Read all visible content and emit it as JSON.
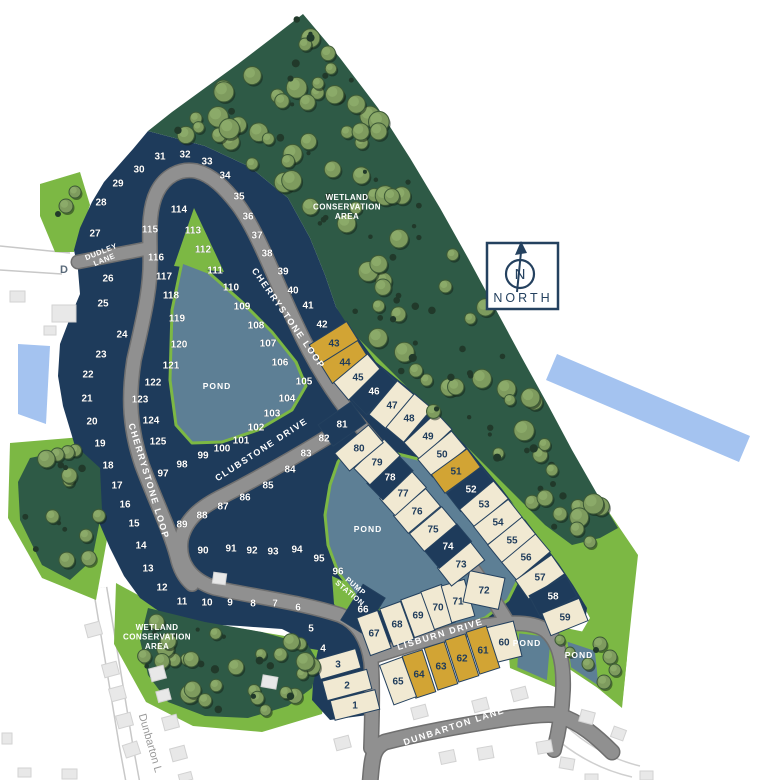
{
  "palette": {
    "navy": "#1e3b5b",
    "cream": "#f1e9d2",
    "gold": "#d2a434",
    "forest": "#2e5a46",
    "grass": "#7cb844",
    "pond": "#5d7f95",
    "road": "#909090",
    "road_edge": "#6f6f6f",
    "stream": "#a4c3f0",
    "house": "#e8e8e8"
  },
  "compass": {
    "letter": "N",
    "label": "NORTH"
  },
  "road_labels": [
    {
      "text": "CHERRYSTONE LOOP",
      "x": 286,
      "y": 320,
      "rot": 55,
      "cls": "roadlbl"
    },
    {
      "text": "CHERRYSTONE LOOP",
      "x": 146,
      "y": 482,
      "rot": 73,
      "cls": "roadlbl"
    },
    {
      "text": "CLUBSTONE DRIVE",
      "x": 263,
      "y": 452,
      "rot": -33,
      "cls": "roadlbl"
    },
    {
      "text": "LISBURN DRIVE",
      "x": 441,
      "y": 637,
      "rot": -17,
      "cls": "roadlbl"
    },
    {
      "text": "DUNBARTON LANE",
      "x": 455,
      "y": 729,
      "rot": -18,
      "cls": "roadlbl"
    }
  ],
  "dudley": {
    "lines": [
      "DUDLEY",
      "LANE"
    ],
    "x": 102,
    "y": 254,
    "rot": -22
  },
  "pump_station": {
    "lines": [
      "PUMP",
      "STATION"
    ],
    "x": 354,
    "y": 588,
    "rot": 40
  },
  "wetlands": [
    {
      "lines": [
        "WETLAND",
        "CONSERVATION",
        "AREA"
      ],
      "x": 347,
      "y": 200
    },
    {
      "lines": [
        "WETLAND",
        "CONSERVATION",
        "AREA"
      ],
      "x": 157,
      "y": 630
    }
  ],
  "ponds": [
    {
      "text": "POND",
      "x": 217,
      "y": 389
    },
    {
      "text": "POND",
      "x": 368,
      "y": 532
    },
    {
      "text": "POND",
      "x": 527,
      "y": 646
    },
    {
      "text": "POND",
      "x": 579,
      "y": 658
    }
  ],
  "offsite": {
    "dunbarton_fragment": "Dunbarton L",
    "dx": 147,
    "dy": 744,
    "drot": 74,
    "d_fragment": "D",
    "fx": 64,
    "fy": 273
  },
  "lots": [
    {
      "n": "1",
      "x": 355,
      "y": 705,
      "c": "cream",
      "rw": 46,
      "rh": 20,
      "rr": -14
    },
    {
      "n": "2",
      "x": 347,
      "y": 685,
      "c": "cream",
      "rw": 46,
      "rh": 20,
      "rr": -15
    },
    {
      "n": "3",
      "x": 338,
      "y": 664,
      "c": "cream",
      "rw": 42,
      "rh": 20,
      "rr": -16
    },
    {
      "n": "4",
      "x": 323,
      "y": 648,
      "c": "navy"
    },
    {
      "n": "5",
      "x": 311,
      "y": 628,
      "c": "navy"
    },
    {
      "n": "6",
      "x": 298,
      "y": 607,
      "c": "navy"
    },
    {
      "n": "7",
      "x": 275,
      "y": 603,
      "c": "navy"
    },
    {
      "n": "8",
      "x": 253,
      "y": 603,
      "c": "navy"
    },
    {
      "n": "9",
      "x": 230,
      "y": 602,
      "c": "navy"
    },
    {
      "n": "10",
      "x": 207,
      "y": 602,
      "c": "navy"
    },
    {
      "n": "11",
      "x": 182,
      "y": 601,
      "c": "navy"
    },
    {
      "n": "12",
      "x": 162,
      "y": 587,
      "c": "navy"
    },
    {
      "n": "13",
      "x": 148,
      "y": 568,
      "c": "navy"
    },
    {
      "n": "14",
      "x": 141,
      "y": 545,
      "c": "navy"
    },
    {
      "n": "15",
      "x": 134,
      "y": 523,
      "c": "navy"
    },
    {
      "n": "16",
      "x": 125,
      "y": 504,
      "c": "navy"
    },
    {
      "n": "17",
      "x": 117,
      "y": 485,
      "c": "navy"
    },
    {
      "n": "18",
      "x": 108,
      "y": 465,
      "c": "navy"
    },
    {
      "n": "19",
      "x": 100,
      "y": 443,
      "c": "navy"
    },
    {
      "n": "20",
      "x": 92,
      "y": 421,
      "c": "navy"
    },
    {
      "n": "21",
      "x": 87,
      "y": 398,
      "c": "navy"
    },
    {
      "n": "22",
      "x": 88,
      "y": 374,
      "c": "navy"
    },
    {
      "n": "23",
      "x": 101,
      "y": 354,
      "c": "navy"
    },
    {
      "n": "24",
      "x": 122,
      "y": 334,
      "c": "navy"
    },
    {
      "n": "25",
      "x": 103,
      "y": 303,
      "c": "navy"
    },
    {
      "n": "26",
      "x": 108,
      "y": 278,
      "c": "navy"
    },
    {
      "n": "27",
      "x": 95,
      "y": 233,
      "c": "navy"
    },
    {
      "n": "28",
      "x": 101,
      "y": 202,
      "c": "navy"
    },
    {
      "n": "29",
      "x": 118,
      "y": 183,
      "c": "navy"
    },
    {
      "n": "30",
      "x": 139,
      "y": 169,
      "c": "navy"
    },
    {
      "n": "31",
      "x": 160,
      "y": 156,
      "c": "navy"
    },
    {
      "n": "32",
      "x": 185,
      "y": 154,
      "c": "navy"
    },
    {
      "n": "33",
      "x": 207,
      "y": 161,
      "c": "navy"
    },
    {
      "n": "34",
      "x": 225,
      "y": 175,
      "c": "navy"
    },
    {
      "n": "35",
      "x": 239,
      "y": 196,
      "c": "navy"
    },
    {
      "n": "36",
      "x": 248,
      "y": 216,
      "c": "navy"
    },
    {
      "n": "37",
      "x": 257,
      "y": 235,
      "c": "navy"
    },
    {
      "n": "38",
      "x": 267,
      "y": 253,
      "c": "navy"
    },
    {
      "n": "39",
      "x": 283,
      "y": 271,
      "c": "navy"
    },
    {
      "n": "40",
      "x": 293,
      "y": 290,
      "c": "navy"
    },
    {
      "n": "41",
      "x": 308,
      "y": 305,
      "c": "navy"
    },
    {
      "n": "42",
      "x": 322,
      "y": 324,
      "c": "navy"
    },
    {
      "n": "43",
      "x": 334,
      "y": 343,
      "c": "gold",
      "rw": 23,
      "rh": 44,
      "rr": 58
    },
    {
      "n": "44",
      "x": 345,
      "y": 362,
      "c": "gold",
      "rw": 23,
      "rh": 44,
      "rr": 58
    },
    {
      "n": "45",
      "x": 358,
      "y": 377,
      "c": "cream",
      "rw": 23,
      "rh": 44,
      "rr": 50
    },
    {
      "n": "46",
      "x": 374,
      "y": 391,
      "c": "navy",
      "rw": 23,
      "rh": 44,
      "rr": 45
    },
    {
      "n": "47",
      "x": 392,
      "y": 405,
      "c": "cream",
      "rw": 23,
      "rh": 44,
      "rr": 40
    },
    {
      "n": "48",
      "x": 409,
      "y": 418,
      "c": "cream",
      "rw": 23,
      "rh": 44,
      "rr": 40
    },
    {
      "n": "49",
      "x": 428,
      "y": 436,
      "c": "cream",
      "rw": 23,
      "rh": 44,
      "rr": 47
    },
    {
      "n": "50",
      "x": 442,
      "y": 454,
      "c": "cream",
      "rw": 23,
      "rh": 44,
      "rr": 50
    },
    {
      "n": "51",
      "x": 456,
      "y": 471,
      "c": "gold",
      "rw": 23,
      "rh": 44,
      "rr": 54
    },
    {
      "n": "52",
      "x": 471,
      "y": 489,
      "c": "navy",
      "rw": 23,
      "rh": 44,
      "rr": 52
    },
    {
      "n": "53",
      "x": 484,
      "y": 504,
      "c": "cream",
      "rw": 23,
      "rh": 44,
      "rr": 50
    },
    {
      "n": "54",
      "x": 498,
      "y": 522,
      "c": "cream",
      "rw": 23,
      "rh": 44,
      "rr": 52
    },
    {
      "n": "55",
      "x": 512,
      "y": 540,
      "c": "cream",
      "rw": 23,
      "rh": 44,
      "rr": 51
    },
    {
      "n": "56",
      "x": 526,
      "y": 557,
      "c": "cream",
      "rw": 23,
      "rh": 44,
      "rr": 50
    },
    {
      "n": "57",
      "x": 540,
      "y": 577,
      "c": "cream",
      "rw": 23,
      "rh": 44,
      "rr": 55
    },
    {
      "n": "58",
      "x": 553,
      "y": 596,
      "c": "navy",
      "rw": 23,
      "rh": 42,
      "rr": 62
    },
    {
      "n": "59",
      "x": 565,
      "y": 617,
      "c": "cream",
      "rw": 24,
      "rh": 40,
      "rr": 68
    },
    {
      "n": "60",
      "x": 504,
      "y": 642,
      "c": "cream",
      "rw": 28,
      "rh": 36,
      "rr": -14
    },
    {
      "n": "61",
      "x": 483,
      "y": 650,
      "c": "gold",
      "rw": 21,
      "rh": 44,
      "rr": -18
    },
    {
      "n": "62",
      "x": 462,
      "y": 658,
      "c": "gold",
      "rw": 21,
      "rh": 44,
      "rr": -18
    },
    {
      "n": "63",
      "x": 441,
      "y": 666,
      "c": "gold",
      "rw": 21,
      "rh": 44,
      "rr": -18
    },
    {
      "n": "64",
      "x": 419,
      "y": 674,
      "c": "gold",
      "rw": 21,
      "rh": 44,
      "rr": -18
    },
    {
      "n": "65",
      "x": 398,
      "y": 681,
      "c": "cream",
      "rw": 24,
      "rh": 42,
      "rr": -20
    },
    {
      "n": "66",
      "x": 363,
      "y": 609,
      "c": "navy",
      "rw": 26,
      "rh": 42,
      "rr": 32
    },
    {
      "n": "67",
      "x": 374,
      "y": 633,
      "c": "cream",
      "rw": 22,
      "rh": 40,
      "rr": -20
    },
    {
      "n": "68",
      "x": 397,
      "y": 624,
      "c": "cream",
      "rw": 22,
      "rh": 40,
      "rr": -20
    },
    {
      "n": "69",
      "x": 418,
      "y": 615,
      "c": "cream",
      "rw": 22,
      "rh": 40,
      "rr": -20
    },
    {
      "n": "70",
      "x": 438,
      "y": 607,
      "c": "cream",
      "rw": 22,
      "rh": 40,
      "rr": -20
    },
    {
      "n": "71",
      "x": 458,
      "y": 601,
      "c": "cream",
      "rw": 24,
      "rh": 38,
      "rr": -16
    },
    {
      "n": "72",
      "x": 484,
      "y": 590,
      "c": "cream",
      "rw": 36,
      "rh": 32,
      "rr": 12
    },
    {
      "n": "73",
      "x": 461,
      "y": 564,
      "c": "cream",
      "rw": 23,
      "rh": 42,
      "rr": 52
    },
    {
      "n": "74",
      "x": 448,
      "y": 546,
      "c": "navy",
      "rw": 23,
      "rh": 42,
      "rr": 50
    },
    {
      "n": "75",
      "x": 433,
      "y": 529,
      "c": "cream",
      "rw": 23,
      "rh": 42,
      "rr": 50
    },
    {
      "n": "76",
      "x": 417,
      "y": 511,
      "c": "cream",
      "rw": 23,
      "rh": 42,
      "rr": 50
    },
    {
      "n": "77",
      "x": 403,
      "y": 493,
      "c": "cream",
      "rw": 23,
      "rh": 42,
      "rr": 48
    },
    {
      "n": "78",
      "x": 390,
      "y": 477,
      "c": "navy",
      "rw": 23,
      "rh": 42,
      "rr": 46
    },
    {
      "n": "79",
      "x": 377,
      "y": 462,
      "c": "cream",
      "rw": 23,
      "rh": 42,
      "rr": 46
    },
    {
      "n": "80",
      "x": 359,
      "y": 448,
      "c": "cream",
      "rw": 23,
      "rh": 44,
      "rr": 50
    },
    {
      "n": "81",
      "x": 342,
      "y": 424,
      "c": "navy",
      "rw": 26,
      "rh": 40,
      "rr": 55
    },
    {
      "n": "82",
      "x": 324,
      "y": 438,
      "c": "navy"
    },
    {
      "n": "83",
      "x": 306,
      "y": 453,
      "c": "navy"
    },
    {
      "n": "84",
      "x": 290,
      "y": 469,
      "c": "navy"
    },
    {
      "n": "85",
      "x": 268,
      "y": 485,
      "c": "navy"
    },
    {
      "n": "86",
      "x": 245,
      "y": 497,
      "c": "navy"
    },
    {
      "n": "87",
      "x": 223,
      "y": 506,
      "c": "navy"
    },
    {
      "n": "88",
      "x": 202,
      "y": 515,
      "c": "navy"
    },
    {
      "n": "89",
      "x": 182,
      "y": 524,
      "c": "navy"
    },
    {
      "n": "90",
      "x": 203,
      "y": 550,
      "c": "navy"
    },
    {
      "n": "91",
      "x": 231,
      "y": 548,
      "c": "navy"
    },
    {
      "n": "92",
      "x": 252,
      "y": 550,
      "c": "navy"
    },
    {
      "n": "93",
      "x": 273,
      "y": 551,
      "c": "navy"
    },
    {
      "n": "94",
      "x": 297,
      "y": 549,
      "c": "navy"
    },
    {
      "n": "95",
      "x": 319,
      "y": 558,
      "c": "navy"
    },
    {
      "n": "96",
      "x": 338,
      "y": 571,
      "c": "navy"
    },
    {
      "n": "97",
      "x": 163,
      "y": 473,
      "c": "navy"
    },
    {
      "n": "98",
      "x": 182,
      "y": 464,
      "c": "navy"
    },
    {
      "n": "99",
      "x": 203,
      "y": 455,
      "c": "navy"
    },
    {
      "n": "100",
      "x": 222,
      "y": 448,
      "c": "navy"
    },
    {
      "n": "101",
      "x": 241,
      "y": 440,
      "c": "navy"
    },
    {
      "n": "102",
      "x": 256,
      "y": 427,
      "c": "navy"
    },
    {
      "n": "103",
      "x": 272,
      "y": 413,
      "c": "navy"
    },
    {
      "n": "104",
      "x": 287,
      "y": 398,
      "c": "navy"
    },
    {
      "n": "105",
      "x": 304,
      "y": 381,
      "c": "navy"
    },
    {
      "n": "106",
      "x": 280,
      "y": 362,
      "c": "navy"
    },
    {
      "n": "107",
      "x": 268,
      "y": 343,
      "c": "navy"
    },
    {
      "n": "108",
      "x": 256,
      "y": 325,
      "c": "navy"
    },
    {
      "n": "109",
      "x": 242,
      "y": 306,
      "c": "navy"
    },
    {
      "n": "110",
      "x": 231,
      "y": 287,
      "c": "navy"
    },
    {
      "n": "111",
      "x": 215,
      "y": 270,
      "c": "navy"
    },
    {
      "n": "112",
      "x": 203,
      "y": 249,
      "c": "navy"
    },
    {
      "n": "113",
      "x": 193,
      "y": 230,
      "c": "navy"
    },
    {
      "n": "114",
      "x": 179,
      "y": 209,
      "c": "navy"
    },
    {
      "n": "115",
      "x": 150,
      "y": 229,
      "c": "navy"
    },
    {
      "n": "116",
      "x": 156,
      "y": 257,
      "c": "navy"
    },
    {
      "n": "117",
      "x": 164,
      "y": 276,
      "c": "navy"
    },
    {
      "n": "118",
      "x": 171,
      "y": 295,
      "c": "navy"
    },
    {
      "n": "119",
      "x": 177,
      "y": 318,
      "c": "navy"
    },
    {
      "n": "120",
      "x": 179,
      "y": 344,
      "c": "navy"
    },
    {
      "n": "121",
      "x": 171,
      "y": 365,
      "c": "navy"
    },
    {
      "n": "122",
      "x": 153,
      "y": 382,
      "c": "navy"
    },
    {
      "n": "123",
      "x": 140,
      "y": 399,
      "c": "navy"
    },
    {
      "n": "124",
      "x": 151,
      "y": 420,
      "c": "navy"
    },
    {
      "n": "125",
      "x": 158,
      "y": 441,
      "c": "navy"
    }
  ]
}
